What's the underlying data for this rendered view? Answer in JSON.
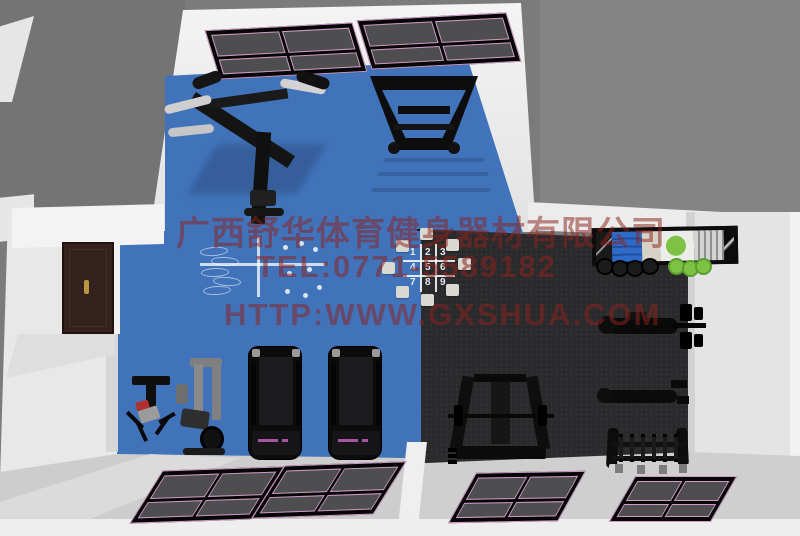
{
  "watermark": {
    "company": "广西舒华体育健身器材有限公司",
    "phone": "TEL:0771-5589182",
    "website": "HTTP:WWW.GXSHUA.COM"
  },
  "agility_mat": {
    "digits": [
      "1",
      "2",
      "3",
      "4",
      "5",
      "6",
      "7",
      "8",
      "9"
    ]
  },
  "colors": {
    "background": "#7b7b7b",
    "wall": "#ededed",
    "floor_blue": "#4173bb",
    "carpet_dark": "#2a2a2c",
    "window_glass": "#4e4e50",
    "window_trim_pink": "#cf9ac6",
    "door_brown": "#35211d",
    "watermark_red": "#8c241f",
    "ball_green": "#7dc242"
  },
  "equipment": [
    {
      "name": "multi-station-gym",
      "area": "top-room"
    },
    {
      "name": "hack-squat-machine",
      "area": "top-room"
    },
    {
      "name": "agility-mat-numbered",
      "area": "main-floor"
    },
    {
      "name": "court-floor-markings",
      "area": "main-floor"
    },
    {
      "name": "treadmill-left",
      "area": "main-floor"
    },
    {
      "name": "treadmill-right",
      "area": "main-floor"
    },
    {
      "name": "weight-bench-red",
      "area": "main-floor"
    },
    {
      "name": "cable-multigym",
      "area": "main-floor"
    },
    {
      "name": "squat-rack",
      "area": "weights-room"
    },
    {
      "name": "bench-press",
      "area": "weights-room"
    },
    {
      "name": "flat-bench",
      "area": "weights-room"
    },
    {
      "name": "dumbbell-rack",
      "area": "weights-room"
    },
    {
      "name": "storage-shelf",
      "area": "weights-room"
    },
    {
      "name": "kettlebells",
      "area": "weights-room"
    },
    {
      "name": "exercise-balls",
      "area": "weights-room"
    }
  ]
}
